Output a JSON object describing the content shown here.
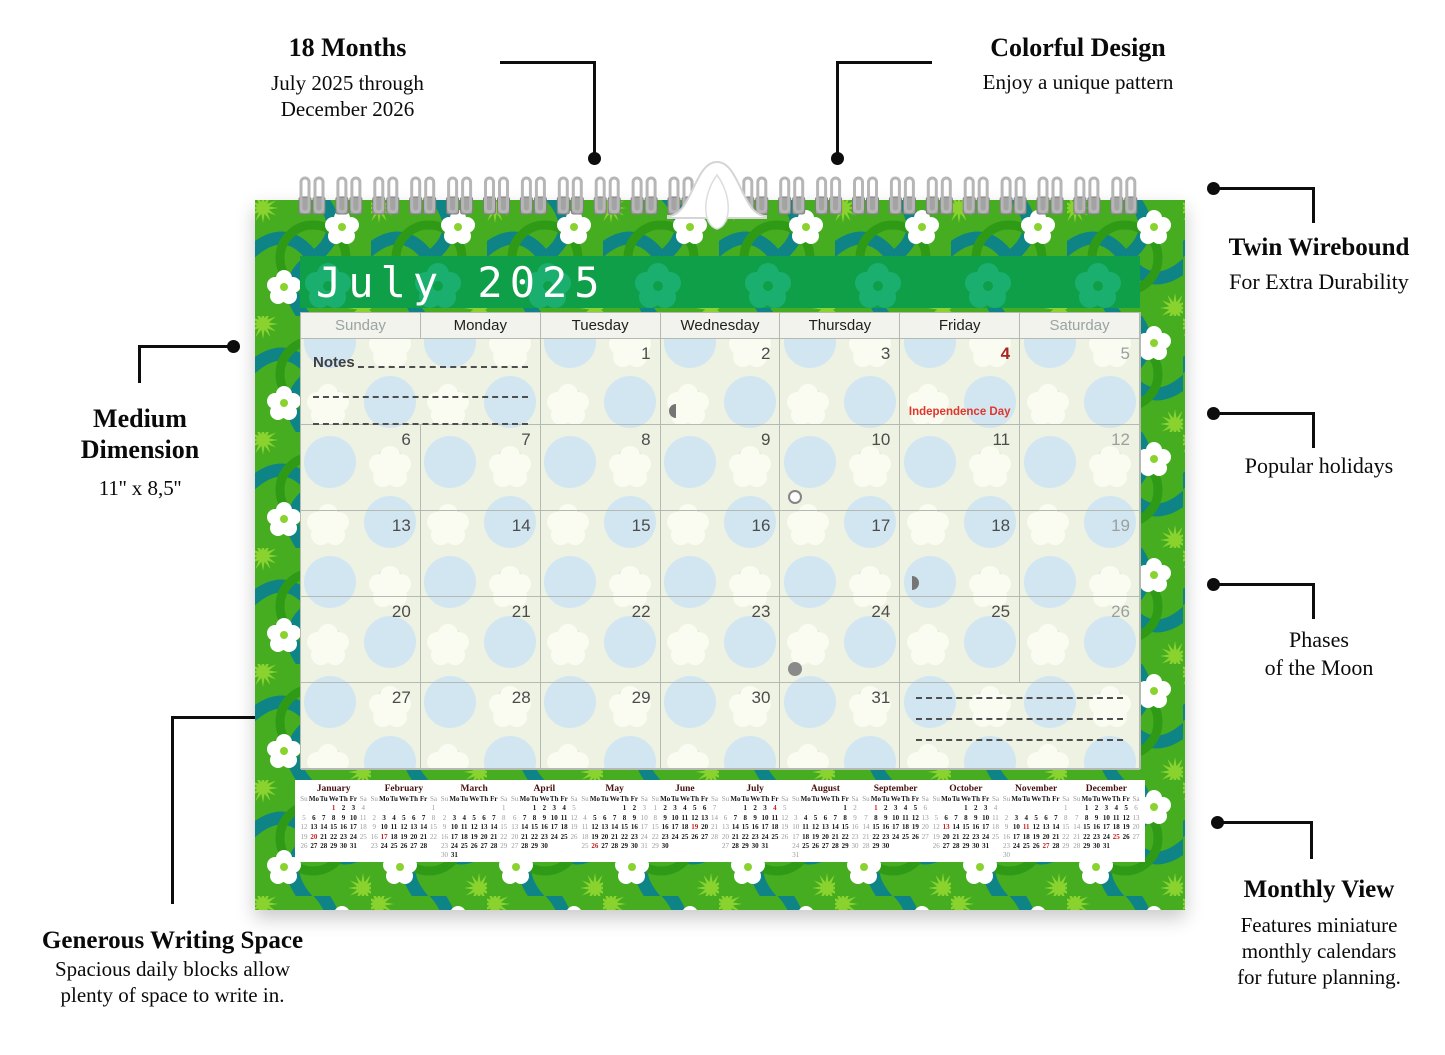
{
  "annotations": {
    "months18": {
      "title": "18 Months",
      "line1": "July 2025 through",
      "line2": "December 2026"
    },
    "colorful": {
      "title": "Colorful Design",
      "line1": "Enjoy a unique pattern"
    },
    "wirebound": {
      "title": "Twin Wirebound",
      "line1": "For Extra Durability"
    },
    "holidays": {
      "title": "Popular holidays"
    },
    "moon": {
      "line1": "Phases",
      "line2": "of the Moon"
    },
    "monthly": {
      "title": "Monthly View",
      "line1": "Features miniature",
      "line2": "monthly calendars",
      "line3": "for future planning."
    },
    "dimension": {
      "title1": "Medium",
      "title2": "Dimension",
      "line1": "11'' x 8,5''"
    },
    "writing": {
      "title": "Generous Writing Space",
      "line1": "Spacious daily blocks allow",
      "line2": "plenty of space to write in."
    }
  },
  "calendar": {
    "title": "July 2025",
    "day_headers": [
      "Sunday",
      "Monday",
      "Tuesday",
      "Wednesday",
      "Thursday",
      "Friday",
      "Saturday"
    ],
    "notes_label": "Notes",
    "holiday_label": "Independence Day",
    "weeks": [
      [
        {
          "type": "notes",
          "span": 2
        },
        {
          "d": 1
        },
        {
          "d": 2,
          "moon": "first-quarter"
        },
        {
          "d": 3
        },
        {
          "d": 4,
          "red": true,
          "holiday": true
        },
        {
          "d": 5,
          "wknd": true
        }
      ],
      [
        {
          "d": 6
        },
        {
          "d": 7
        },
        {
          "d": 8
        },
        {
          "d": 9
        },
        {
          "d": 10,
          "moon": "full"
        },
        {
          "d": 11
        },
        {
          "d": 12,
          "wknd": true
        }
      ],
      [
        {
          "d": 13
        },
        {
          "d": 14
        },
        {
          "d": 15
        },
        {
          "d": 16
        },
        {
          "d": 17
        },
        {
          "d": 18,
          "moon": "last-quarter"
        },
        {
          "d": 19,
          "wknd": true
        }
      ],
      [
        {
          "d": 20
        },
        {
          "d": 21
        },
        {
          "d": 22
        },
        {
          "d": 23
        },
        {
          "d": 24,
          "moon": "new"
        },
        {
          "d": 25
        },
        {
          "d": 26,
          "wknd": true
        }
      ],
      [
        {
          "d": 27
        },
        {
          "d": 28
        },
        {
          "d": 29
        },
        {
          "d": 30
        },
        {
          "d": 31
        },
        {
          "type": "dashes",
          "span": 2
        }
      ]
    ]
  },
  "mini_day_headers": [
    "Su",
    "Mo",
    "Tu",
    "We",
    "Th",
    "Fr",
    "Sa"
  ],
  "mini_months": [
    {
      "name": "January",
      "start": 3,
      "days": 31,
      "red": [
        1,
        20
      ]
    },
    {
      "name": "February",
      "start": 6,
      "days": 28,
      "red": [
        17
      ]
    },
    {
      "name": "March",
      "start": 6,
      "days": 31,
      "red": []
    },
    {
      "name": "April",
      "start": 2,
      "days": 30,
      "red": []
    },
    {
      "name": "May",
      "start": 4,
      "days": 31,
      "red": [
        26
      ]
    },
    {
      "name": "June",
      "start": 0,
      "days": 30,
      "red": [
        19
      ]
    },
    {
      "name": "July",
      "start": 2,
      "days": 31,
      "red": [
        4
      ]
    },
    {
      "name": "August",
      "start": 5,
      "days": 31,
      "red": []
    },
    {
      "name": "September",
      "start": 1,
      "days": 30,
      "red": [
        1
      ]
    },
    {
      "name": "October",
      "start": 3,
      "days": 31,
      "red": [
        13
      ]
    },
    {
      "name": "November",
      "start": 6,
      "days": 30,
      "red": [
        11,
        27
      ]
    },
    {
      "name": "December",
      "start": 1,
      "days": 31,
      "red": [
        25
      ]
    }
  ],
  "colors": {
    "pattern_green": "#46ad20",
    "pattern_teal": "#0e8486",
    "pattern_lime": "#8ad32f",
    "title_green": "#0f9f48",
    "holiday_red": "#e0352a",
    "mini_red": "#c41a1a"
  }
}
